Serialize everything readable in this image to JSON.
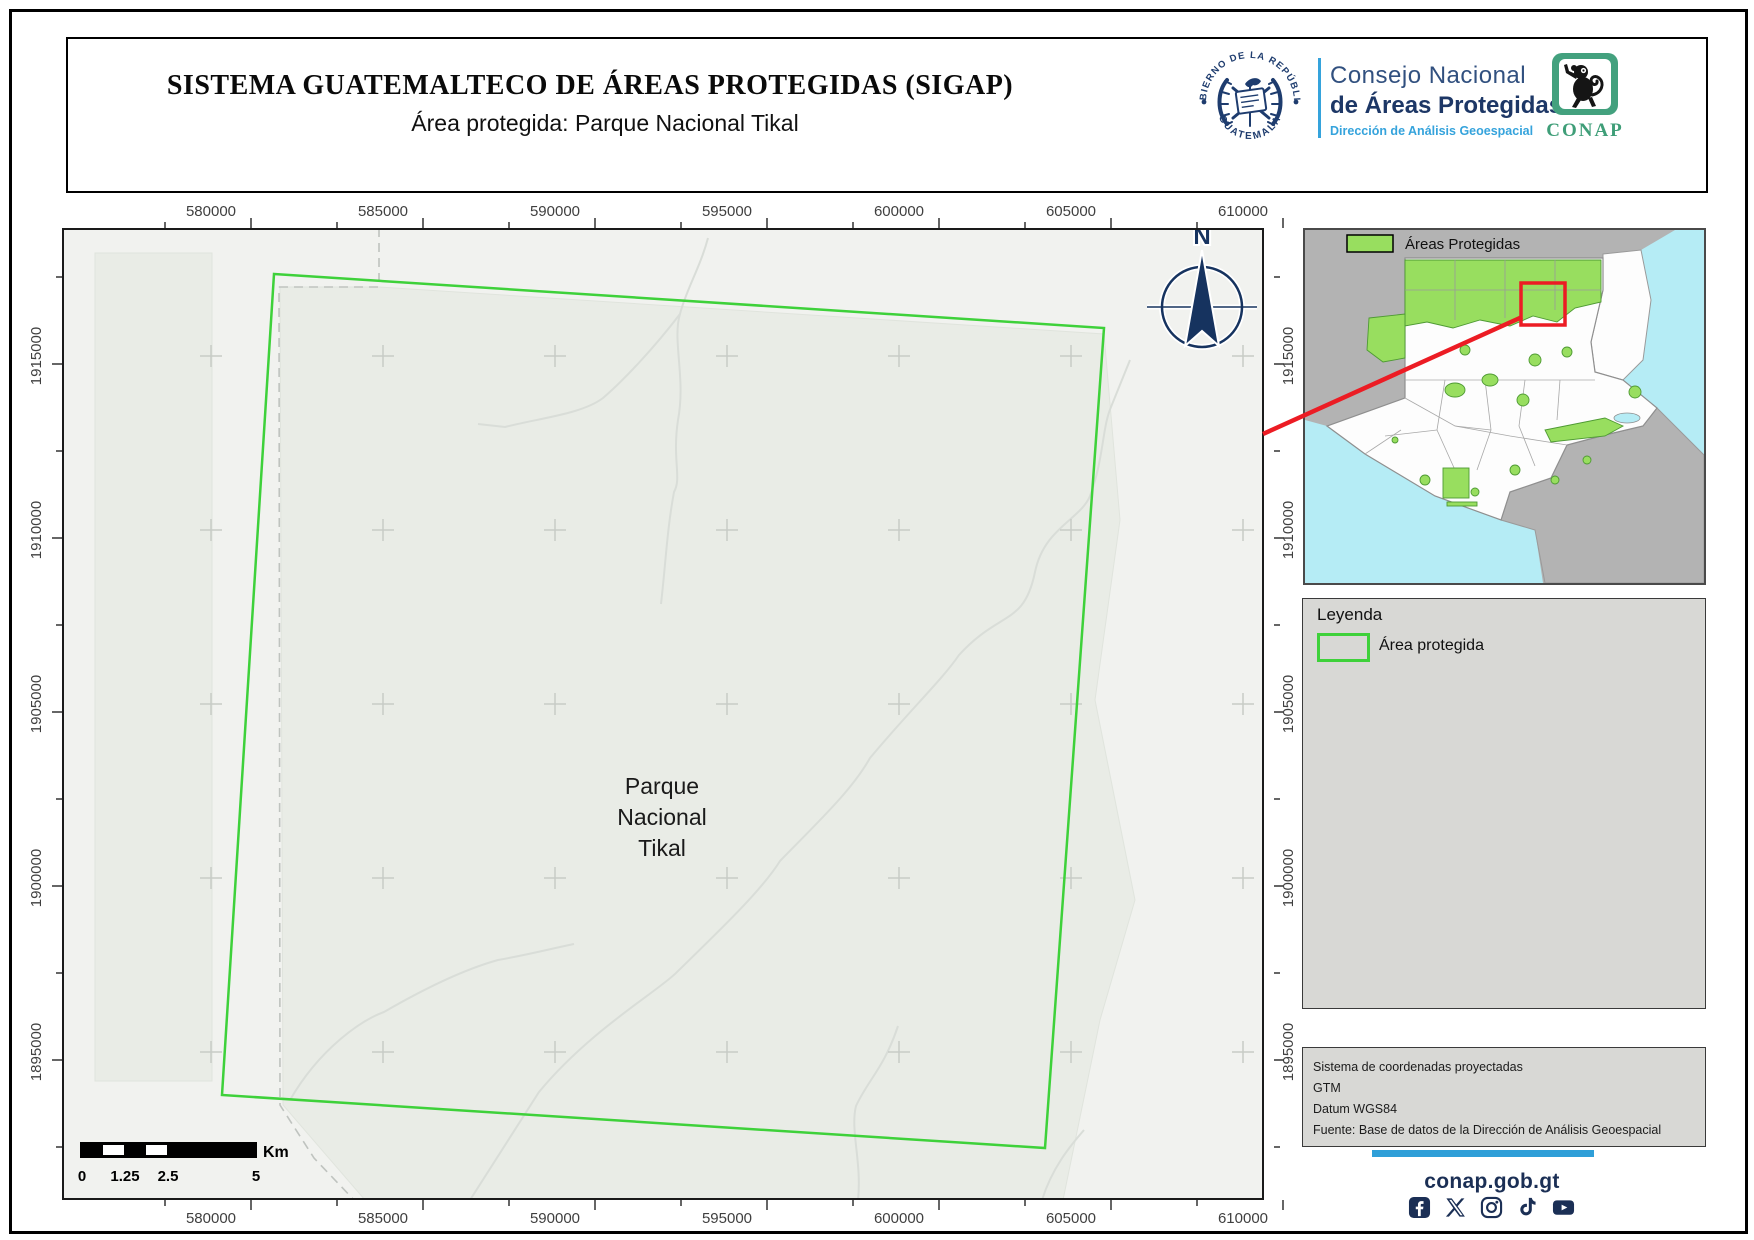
{
  "header": {
    "title": "SISTEMA GUATEMALTECO DE ÁREAS PROTEGIDAS  (SIGAP)",
    "subtitle": "Área protegida: Parque Nacional Tikal",
    "seal_top_text": "GOBIERNO DE LA REPÚBLICA",
    "seal_bottom_text": "GUATEMALA",
    "org_line1": "Consejo Nacional",
    "org_line2": "de Áreas Protegidas",
    "org_line3": "Dirección de Análisis Geoespacial",
    "conap_logo_text": "CONAP"
  },
  "map": {
    "x_ticks": [
      "580000",
      "585000",
      "590000",
      "595000",
      "600000",
      "605000",
      "610000"
    ],
    "y_ticks": [
      "1915000",
      "1910000",
      "1905000",
      "1900000",
      "1895000"
    ],
    "area_label_line1": "Parque",
    "area_label_line2": "Nacional",
    "area_label_line3": "Tikal",
    "north_label": "N",
    "scalebar": {
      "label0": "0",
      "label1": "1.25",
      "label2": "2.5",
      "label3": "5",
      "unit": "Km"
    }
  },
  "inset": {
    "legend_label": "Áreas Protegidas"
  },
  "legend": {
    "title": "Leyenda",
    "item": "Área protegida"
  },
  "info_box": {
    "line1": "Sistema de coordenadas proyectadas",
    "line2": "GTM",
    "line3": "Datum WGS84",
    "line4": "Fuente: Base de datos de la Dirección de Análisis Geoespacial"
  },
  "footer": {
    "website": "conap.gob.gt",
    "social": [
      "facebook",
      "x",
      "instagram",
      "tiktok",
      "youtube"
    ]
  },
  "colors": {
    "boundary_green": "#3ed13a",
    "protected_fill": "#98de5f",
    "sea_cyan": "#b5ecf5",
    "navy": "#1d3766",
    "light_blue": "#35a3dc",
    "locator_red": "#ec1c24"
  }
}
